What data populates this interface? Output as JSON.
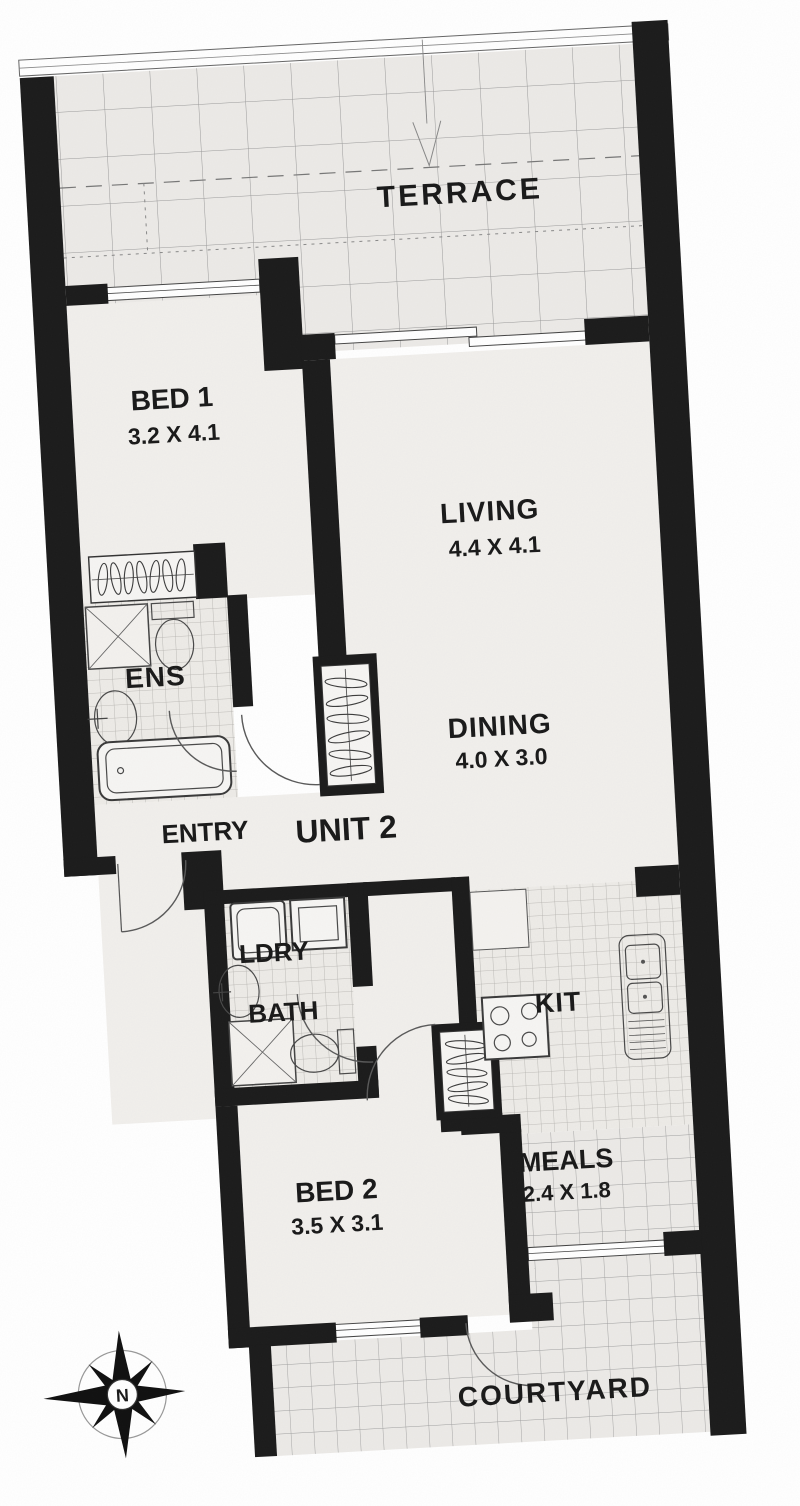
{
  "unit": {
    "label": "UNIT 2"
  },
  "rooms": {
    "terrace": {
      "label": "TERRACE"
    },
    "bed1": {
      "label": "BED 1",
      "dims": "3.2 X 4.1"
    },
    "living": {
      "label": "LIVING",
      "dims": "4.4 X 4.1"
    },
    "dining": {
      "label": "DINING",
      "dims": "4.0 X 3.0"
    },
    "ens": {
      "label": "ENS"
    },
    "entry": {
      "label": "ENTRY"
    },
    "ldry": {
      "label": "LDRY"
    },
    "bath": {
      "label": "BATH"
    },
    "kit": {
      "label": "KIT"
    },
    "meals": {
      "label": "MEALS",
      "dims": "2.4 X 1.8"
    },
    "bed2": {
      "label": "BED 2",
      "dims": "3.5 X 3.1"
    },
    "courtyard": {
      "label": "COURTYARD"
    }
  },
  "compass": {
    "north": "N"
  },
  "colors": {
    "wall": "#1c1c1c",
    "paper": "#ffffff",
    "floor": "#f1efec",
    "tiled_floor": "#eceae7",
    "grid_line": "#9a9a9a",
    "label_text": "#1a1a1a"
  }
}
